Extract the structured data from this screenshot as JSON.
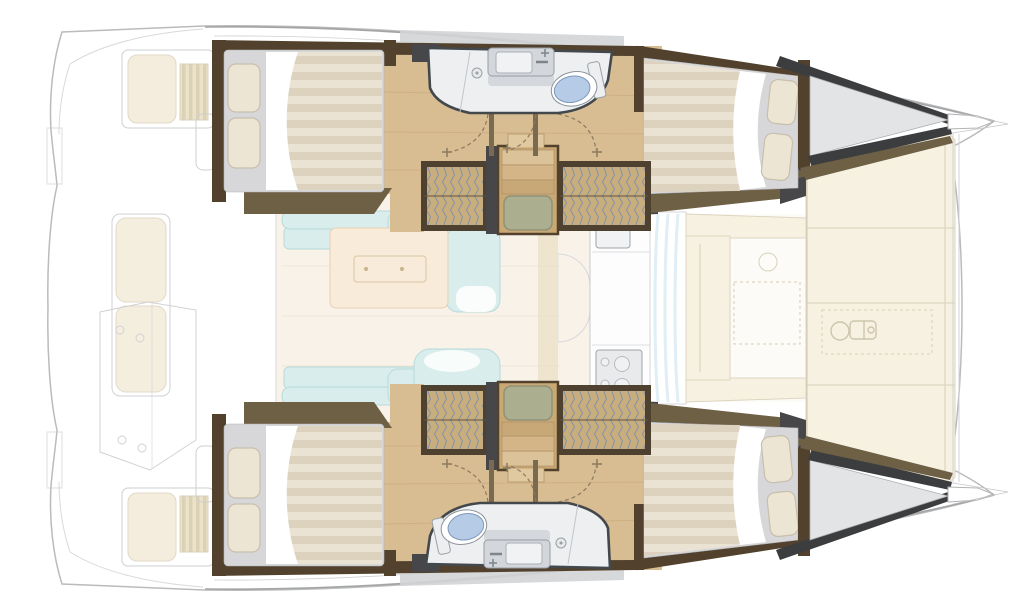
{
  "canvas": {
    "width": 1024,
    "height": 616
  },
  "diagram": {
    "kind": "floor-plan",
    "subject": "catamaran-yacht-accommodation-plan",
    "view": "top-down",
    "bow_direction": "right",
    "stern_direction": "left",
    "symmetry": "port-and-starboard-hulls-mirrored"
  },
  "areas": {
    "aft_cockpit": {
      "style": "ghosted-outline",
      "features": [
        "side-seat-with-cushion",
        "teak-side-table",
        "long-transom-bench",
        "console-outline",
        "transom-steps",
        "helm-pod"
      ]
    },
    "saloon": {
      "features": [
        "u-shaped-sofa",
        "coffee-table",
        "galley-counter",
        "galley-sink",
        "stove",
        "cabinet-door-arcs",
        "forward-sliding-glass-door"
      ]
    },
    "port_hull": {
      "rooms": [
        "aft-double-cabin",
        "shower-room",
        "forward-double-cabin",
        "bow-locker"
      ],
      "features": [
        "double-bed",
        "two-pillows",
        "striped-duvet",
        "hanging-wardrobes",
        "companionway-stairs",
        "non-slip-mat",
        "shower-drain",
        "washbasin-with-faucet",
        "toilet",
        "door-swing-arcs",
        "side-deck-trim"
      ]
    },
    "starboard_hull": {
      "rooms": [
        "aft-double-cabin",
        "shower-room",
        "forward-double-cabin",
        "bow-locker"
      ],
      "features": [
        "double-bed",
        "two-pillows",
        "striped-duvet",
        "hanging-wardrobes",
        "companionway-stairs",
        "non-slip-mat",
        "shower-drain",
        "washbasin-with-faucet",
        "toilet",
        "door-swing-arcs",
        "side-deck-trim"
      ]
    },
    "forward_cockpit": {
      "features": [
        "u-shaped-cushioned-seating",
        "round-table-outline",
        "stitched-seat-panel"
      ]
    },
    "foredeck": {
      "features": [
        "sun-pad-cushions",
        "panel-seams",
        "windlass-outline",
        "bow-points",
        "bowsprit-lines"
      ]
    }
  },
  "colors": {
    "outline": "#b9bbbd",
    "ghost": "#c9cacd",
    "woodFloor": "#d8bc92",
    "woodLine": "#c3a272",
    "woodStair": "#caa873",
    "wallBrown": "#52422d",
    "wallGray": "#47474a",
    "trimOlive": "#6e6044",
    "bowRim": "#3c3d3f",
    "bowDeck": "#e3e4e6",
    "deckWalk": "#d2d4d6",
    "bedBase": "#d7d7d9",
    "duvetLight": "#eae3d4",
    "duvetDark": "#ddd2be",
    "sheet": "#ffffff",
    "pillow": "#ece5d3",
    "pillowEdge": "#c7bfac",
    "bathFill": "#edeff1",
    "bathStroke": "#43484c",
    "sinkMetal": "#d3d7db",
    "basin": "#f0f2f4",
    "faucet": "#7d848b",
    "toiletBlue": "#b5cbe6",
    "toiletEdge": "#7f98bc",
    "sofa": "#d9eeec",
    "sofaEdge": "#b7dbd9",
    "tableCream": "#f8ebd9",
    "tableEdge": "#e4d2b4",
    "salonFloor": "#f9f2e9",
    "counterEdge": "#c7cacd",
    "stoveFill": "#e8eaec",
    "burner": "#b8bcc0",
    "wardrobeTan": "#c8ae7e",
    "wardrobeFrame": "#4e4130",
    "hatchLine": "#8591a4",
    "doorArc": "#8a7a5e",
    "doorWood": "#7a6a4f",
    "stairMat": "#abae8f",
    "matEdge": "#8f9278",
    "stepEdge": "#ad9065",
    "pad": "#f7f1e2",
    "padEdge": "#ddd5bf",
    "ghostPad": "#f3ecda",
    "glass": "#dcedf2",
    "windlass": "#c9c0a6"
  }
}
